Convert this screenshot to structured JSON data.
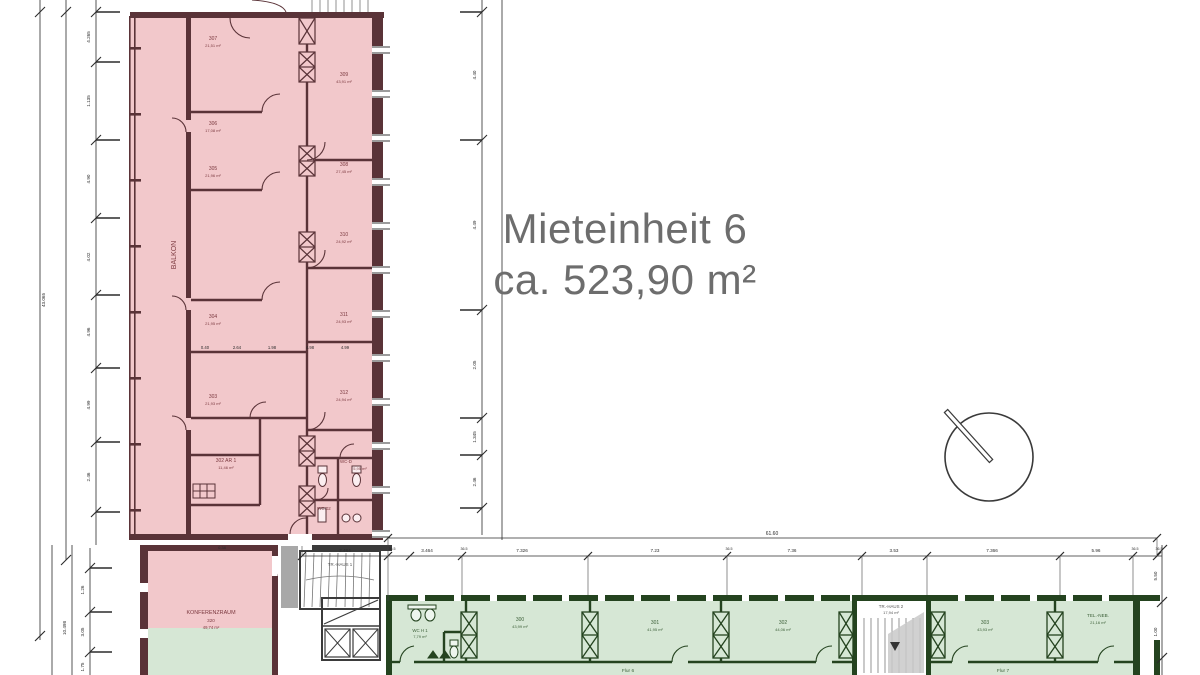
{
  "title": {
    "line1": "Mieteinheit 6",
    "line2": "ca. 523,90 m²"
  },
  "colors": {
    "unit_fill": "#f2c8cb",
    "unit_wall": "#5a3338",
    "common_fill": "#d6e7d5",
    "common_wall": "#24431f",
    "dim_line": "#2b2b2b",
    "title_text": "#6d6d6d",
    "stair_wall": "#3b3b3b"
  },
  "labels": {
    "balcony": "BALKON",
    "conference": {
      "name": "KONFERENZRAUM",
      "number": "320",
      "area": "49,74 m²"
    },
    "stair1": "TR.-HAUS 1",
    "stair2": {
      "name": "TR.-HAUS 2",
      "area": "17,94 m²"
    },
    "flur6": "Flur 6",
    "flur7": "Flur 7",
    "wc_d": "WC-D",
    "wc_d_area": "5,95 m²",
    "wc_02": "WC.02",
    "wc_h1": {
      "name": "WC H 1",
      "area": "7,79 m²"
    },
    "passage": "0.38"
  },
  "rooms_pink": [
    {
      "num": "307",
      "area": "21,51 m²"
    },
    {
      "num": "309",
      "area": "43,91 m²"
    },
    {
      "num": "306",
      "area": "17,08 m²"
    },
    {
      "num": "308",
      "area": "27,45 m²"
    },
    {
      "num": "305",
      "area": "21,96 m²"
    },
    {
      "num": "310",
      "area": "24,92 m²"
    },
    {
      "num": "304",
      "area": "21,95 m²"
    },
    {
      "num": "311",
      "area": "24,93 m²"
    },
    {
      "num": "303",
      "area": "21,93 m²"
    },
    {
      "num": "312",
      "area": "24,94 m²"
    },
    {
      "num": "302 AR 1",
      "area": "11,46 m²"
    }
  ],
  "rooms_green": [
    {
      "num": "300",
      "area": "43,99 m²"
    },
    {
      "num": "301",
      "area": "41,95 m²"
    },
    {
      "num": "302",
      "area": "44,06 m²"
    },
    {
      "num": "303",
      "area": "43,93 m²"
    },
    {
      "num": "TEL.-NEB.",
      "area": "21,16 m²"
    }
  ],
  "dims": {
    "total_top": "61.60",
    "chain_top": [
      "2.464",
      "36.5",
      "3.464",
      "36.5",
      "7.326",
      "7.23",
      "36.5",
      "7.36",
      "3.53",
      "7.366",
      "5.96",
      "36.5",
      "36.5"
    ],
    "left": [
      "4.265",
      "1.135",
      "4.90",
      "4.02",
      "4.96",
      "4.99",
      "2.46"
    ],
    "left_total": "43.065",
    "left_bottom": [
      "1.26",
      "3.05",
      "1.75"
    ],
    "left_bottom_total": "10.498",
    "mid": [
      "4.40",
      "4.49",
      "2.05",
      "1.345",
      "2.46"
    ],
    "inner_row": [
      "0.40",
      "2.64",
      "1.98",
      "4.98",
      "4.99"
    ],
    "right": [
      "5.50",
      "1.00"
    ]
  }
}
